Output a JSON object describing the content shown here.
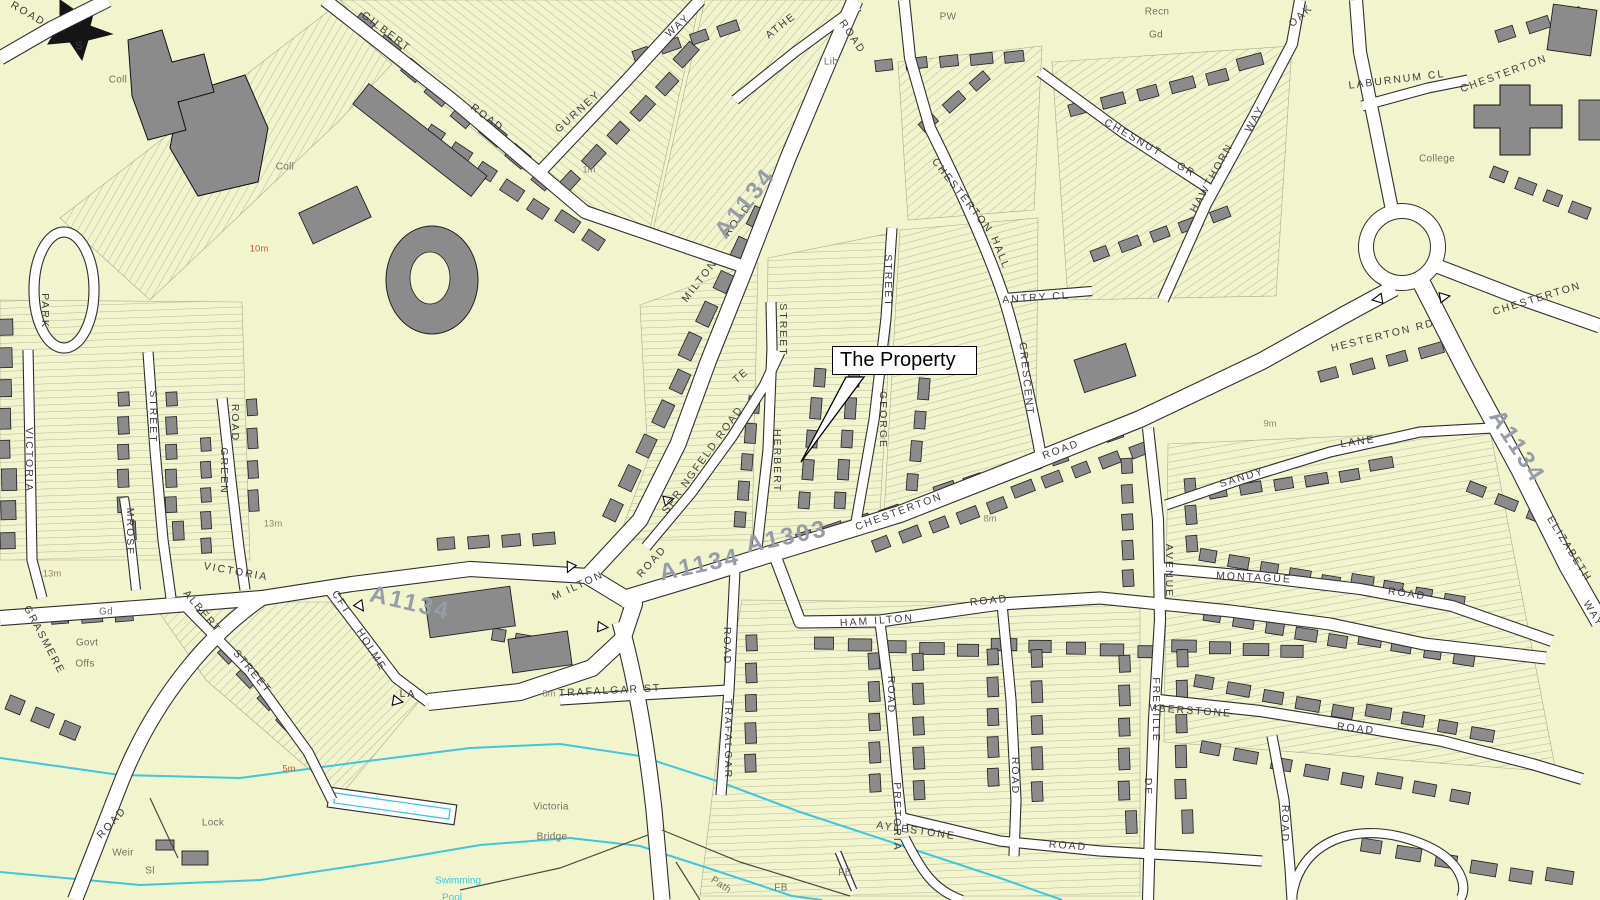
{
  "map": {
    "annotation": {
      "text": "The Property"
    },
    "colors": {
      "land": "#f2f4ce",
      "road_fill": "#ffffff",
      "road_casing": "#2f2f2f",
      "building": "#8b8b8b",
      "building_dark": "#151515",
      "water_line": "#3cc7dd",
      "street_text": "#3c3c3c",
      "place_text": "#70705f",
      "contour_text_orange": "#bf5b2d",
      "contour_text_grey": "#8b8675",
      "road_number_text": "#969da6"
    },
    "street_labels": [
      {
        "t": "ROAD",
        "x": 28,
        "y": 14,
        "r": 30
      },
      {
        "t": "GILBERT",
        "x": 386,
        "y": 32,
        "r": 37
      },
      {
        "t": "ROAD",
        "x": 487,
        "y": 118,
        "r": 37
      },
      {
        "t": "GURNEY",
        "x": 578,
        "y": 112,
        "r": -42
      },
      {
        "t": "WAY",
        "x": 678,
        "y": 26,
        "r": -42
      },
      {
        "t": "ATHE",
        "x": 781,
        "y": 26,
        "r": -38
      },
      {
        "t": "ROAD",
        "x": 852,
        "y": 37,
        "r": 56
      },
      {
        "t": "M ILTON",
        "x": 578,
        "y": 586,
        "r": -25
      },
      {
        "t": "ROAD",
        "x": 652,
        "y": 562,
        "r": -48
      },
      {
        "t": "MILTON",
        "x": 700,
        "y": 281,
        "r": -52
      },
      {
        "t": "ROAD",
        "x": 738,
        "y": 220,
        "r": -52
      },
      {
        "t": "SPR NGFELD ROAD",
        "x": 703,
        "y": 460,
        "r": -54,
        "ls": 1.5,
        "s": 10
      },
      {
        "t": "TE",
        "x": 741,
        "y": 376,
        "r": -40
      },
      {
        "t": "STREET",
        "x": 783,
        "y": 330,
        "r": 90
      },
      {
        "t": "HERBERT",
        "x": 777,
        "y": 461,
        "r": 90
      },
      {
        "t": "STREET",
        "x": 888,
        "y": 281,
        "r": 90
      },
      {
        "t": "GEORGE",
        "x": 883,
        "y": 420,
        "r": 90
      },
      {
        "t": "CHESTERTON",
        "x": 962,
        "y": 196,
        "r": 52
      },
      {
        "t": "HALL",
        "x": 1000,
        "y": 253,
        "r": 68
      },
      {
        "t": "CRESCENT",
        "x": 1026,
        "y": 379,
        "r": 84
      },
      {
        "t": "ANTRY CL",
        "x": 1036,
        "y": 298,
        "r": -4
      },
      {
        "t": "CHESNUT",
        "x": 1133,
        "y": 138,
        "r": 30
      },
      {
        "t": "GR",
        "x": 1186,
        "y": 170,
        "r": 30
      },
      {
        "t": "HAWTHORN",
        "x": 1212,
        "y": 178,
        "r": -61
      },
      {
        "t": "WAY",
        "x": 1255,
        "y": 119,
        "r": -61
      },
      {
        "t": "OAK",
        "x": 1301,
        "y": 16,
        "r": -42
      },
      {
        "t": "LABURNUM CL",
        "x": 1397,
        "y": 80,
        "r": -7,
        "ls": 4
      },
      {
        "t": "CHESTERTON",
        "x": 1504,
        "y": 74,
        "r": -20,
        "ls": 3
      },
      {
        "t": "HESTERTON RD",
        "x": 1383,
        "y": 336,
        "r": -14,
        "ls": 3
      },
      {
        "t": "CHESTERTON",
        "x": 1537,
        "y": 299,
        "r": -17,
        "ls": 3
      },
      {
        "t": "SANDY",
        "x": 1242,
        "y": 478,
        "r": -17
      },
      {
        "t": "LANE",
        "x": 1358,
        "y": 442,
        "r": -8
      },
      {
        "t": "ELIZABETH",
        "x": 1569,
        "y": 549,
        "r": 58
      },
      {
        "t": "WAY",
        "x": 1593,
        "y": 614,
        "r": 58
      },
      {
        "t": "MONTAGUE",
        "x": 1254,
        "y": 578,
        "r": 3,
        "ls": 3
      },
      {
        "t": "ROAD",
        "x": 1407,
        "y": 594,
        "r": 8
      },
      {
        "t": "AVENUE",
        "x": 1169,
        "y": 571,
        "r": 90
      },
      {
        "t": "FREVILLE",
        "x": 1156,
        "y": 710,
        "r": 90
      },
      {
        "t": "DE",
        "x": 1148,
        "y": 787,
        "r": 90
      },
      {
        "t": "CHESTERTON",
        "x": 899,
        "y": 512,
        "r": -20,
        "ls": 3
      },
      {
        "t": "ROAD",
        "x": 1061,
        "y": 450,
        "r": -20
      },
      {
        "t": "HAM ILTON",
        "x": 877,
        "y": 621,
        "r": -4,
        "ls": 2
      },
      {
        "t": "ROAD",
        "x": 989,
        "y": 601,
        "r": -6
      },
      {
        "t": "TRAFALGAR ST",
        "x": 610,
        "y": 691,
        "r": -3,
        "ls": 1
      },
      {
        "t": "ROAD",
        "x": 727,
        "y": 646,
        "r": 90
      },
      {
        "t": "TRAFALGAR",
        "x": 728,
        "y": 739,
        "r": 90
      },
      {
        "t": "ROAD",
        "x": 891,
        "y": 695,
        "r": 90
      },
      {
        "t": "PRETORIA",
        "x": 897,
        "y": 817,
        "r": 90
      },
      {
        "t": "AYLESTONE",
        "x": 916,
        "y": 831,
        "r": 8
      },
      {
        "t": "ROAD",
        "x": 1068,
        "y": 846,
        "r": 4
      },
      {
        "t": "ROAD",
        "x": 1015,
        "y": 776,
        "r": 90
      },
      {
        "t": "MBERSTONE",
        "x": 1190,
        "y": 711,
        "r": 4,
        "ls": 2
      },
      {
        "t": "ROAD",
        "x": 1356,
        "y": 729,
        "r": 7
      },
      {
        "t": "ROAD",
        "x": 1285,
        "y": 824,
        "r": 90
      },
      {
        "t": "VICTORIA",
        "x": 236,
        "y": 572,
        "r": 10
      },
      {
        "t": "ROAD",
        "x": 112,
        "y": 823,
        "r": -48
      },
      {
        "t": "ALBERT",
        "x": 202,
        "y": 612,
        "r": 50
      },
      {
        "t": "STREET",
        "x": 252,
        "y": 672,
        "r": 50
      },
      {
        "t": "CFT",
        "x": 341,
        "y": 603,
        "r": 58
      },
      {
        "t": "HOLME",
        "x": 371,
        "y": 650,
        "r": 58
      },
      {
        "t": "LA",
        "x": 408,
        "y": 694,
        "r": 0
      },
      {
        "t": "GRASMERE",
        "x": 44,
        "y": 640,
        "r": 62,
        "s": 9
      },
      {
        "t": "STREET",
        "x": 153,
        "y": 417,
        "r": 90
      },
      {
        "t": "MROSE",
        "x": 130,
        "y": 532,
        "r": 90
      },
      {
        "t": "ROAD",
        "x": 235,
        "y": 423,
        "r": 90
      },
      {
        "t": "GREEN",
        "x": 224,
        "y": 471,
        "r": 90
      },
      {
        "t": "VICTORIA",
        "x": 29,
        "y": 460,
        "r": 90
      },
      {
        "t": "PARK",
        "x": 45,
        "y": 311,
        "r": 90
      },
      {
        "t": "S",
        "x": 80,
        "y": 46,
        "r": 0
      }
    ],
    "place_labels": [
      {
        "t": "Coll",
        "x": 118,
        "y": 80
      },
      {
        "t": "Coll",
        "x": 285,
        "y": 167
      },
      {
        "t": "College",
        "x": 1437,
        "y": 159
      },
      {
        "t": "Lib",
        "x": 831,
        "y": 62
      },
      {
        "t": "PW",
        "x": 948,
        "y": 17
      },
      {
        "t": "Recn",
        "x": 1157,
        "y": 12
      },
      {
        "t": "Gd",
        "x": 1156,
        "y": 35
      },
      {
        "t": "Gd",
        "x": 106,
        "y": 612
      },
      {
        "t": "Govt",
        "x": 87,
        "y": 643
      },
      {
        "t": "Offs",
        "x": 85,
        "y": 664
      },
      {
        "t": "Victoria",
        "x": 551,
        "y": 807
      },
      {
        "t": "Bridge",
        "x": 552,
        "y": 837
      },
      {
        "t": "Lock",
        "x": 213,
        "y": 823
      },
      {
        "t": "Weir",
        "x": 123,
        "y": 853
      },
      {
        "t": "Sl",
        "x": 150,
        "y": 871
      },
      {
        "t": "Path",
        "x": 721,
        "y": 885,
        "r": 33
      },
      {
        "t": "FB",
        "x": 845,
        "y": 873
      },
      {
        "t": "FB",
        "x": 781,
        "y": 888
      }
    ],
    "contour_labels": [
      {
        "t": "10m",
        "x": 259,
        "y": 249,
        "c": "ct"
      },
      {
        "t": "5m",
        "x": 289,
        "y": 769,
        "c": "ct"
      },
      {
        "t": "1m",
        "x": 589,
        "y": 170,
        "c": "ct2"
      },
      {
        "t": "13m",
        "x": 52,
        "y": 574,
        "c": "ct2"
      },
      {
        "t": "13m",
        "x": 273,
        "y": 524,
        "c": "ct2"
      },
      {
        "t": "8m",
        "x": 549,
        "y": 694,
        "c": "ct2"
      },
      {
        "t": "8m",
        "x": 990,
        "y": 519,
        "c": "ct2"
      },
      {
        "t": "9m",
        "x": 1270,
        "y": 424,
        "c": "ct2"
      }
    ],
    "water_labels": [
      {
        "t": "Swimming",
        "x": 458,
        "y": 881
      },
      {
        "t": "Pool",
        "x": 452,
        "y": 898
      }
    ],
    "road_number_labels": [
      {
        "t": "A1134",
        "x": 746,
        "y": 204,
        "r": -52
      },
      {
        "t": "A1134",
        "x": 700,
        "y": 566,
        "r": -12
      },
      {
        "t": "A1303",
        "x": 787,
        "y": 538,
        "r": -12
      },
      {
        "t": "A1134",
        "x": 410,
        "y": 604,
        "r": 13
      },
      {
        "t": "A1134",
        "x": 1516,
        "y": 447,
        "r": 57
      }
    ],
    "one_way_arrows": [
      {
        "x": 570,
        "y": 567,
        "r": 205
      },
      {
        "x": 602,
        "y": 627,
        "r": 95
      },
      {
        "x": 360,
        "y": 606,
        "r": 145
      },
      {
        "x": 397,
        "y": 701,
        "r": 100
      },
      {
        "x": 668,
        "y": 500,
        "r": 75
      },
      {
        "x": 1378,
        "y": 299,
        "r": 260
      },
      {
        "x": 1444,
        "y": 297,
        "r": 80
      }
    ]
  }
}
